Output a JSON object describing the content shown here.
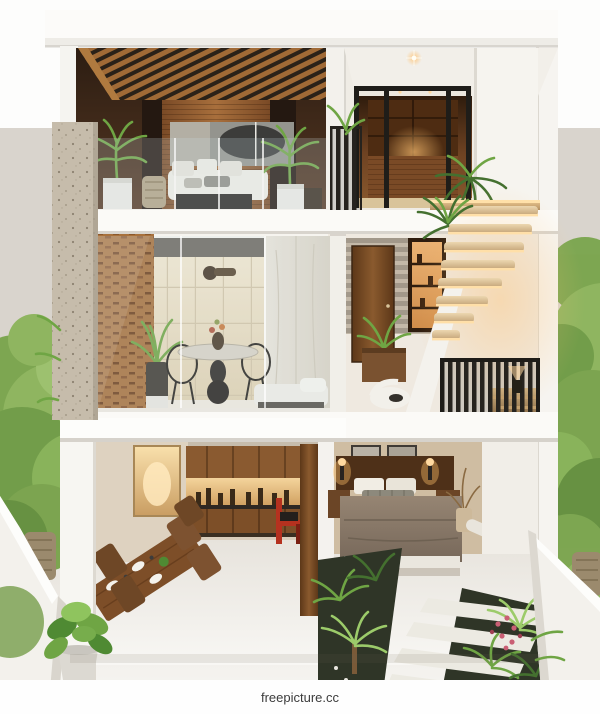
{
  "watermark": {
    "text": "freepicture.cc"
  },
  "palette": {
    "sky": "#fdfdfc",
    "backdrop": "#d9d4cd",
    "wall-white": "#f6f4f0",
    "slab": "#fbfaf7",
    "wood-dark": "#4a2c18",
    "wood-mid": "#9a6432",
    "wood-light": "#c9925a",
    "glow-warm": "#ffc878",
    "glow-deep": "#d97b2e",
    "tile": "#ece1c8",
    "marble": "#e6e1d7",
    "metal-dark": "#26231e",
    "leaf-dark": "#44702f",
    "leaf-mid": "#6fa544",
    "leaf-light": "#9ccb6a",
    "bed-taupe": "#8a7a68",
    "accent-red": "#b5311f",
    "flower-pink": "#c95f74",
    "watermark-text": "#3c3c3c"
  }
}
